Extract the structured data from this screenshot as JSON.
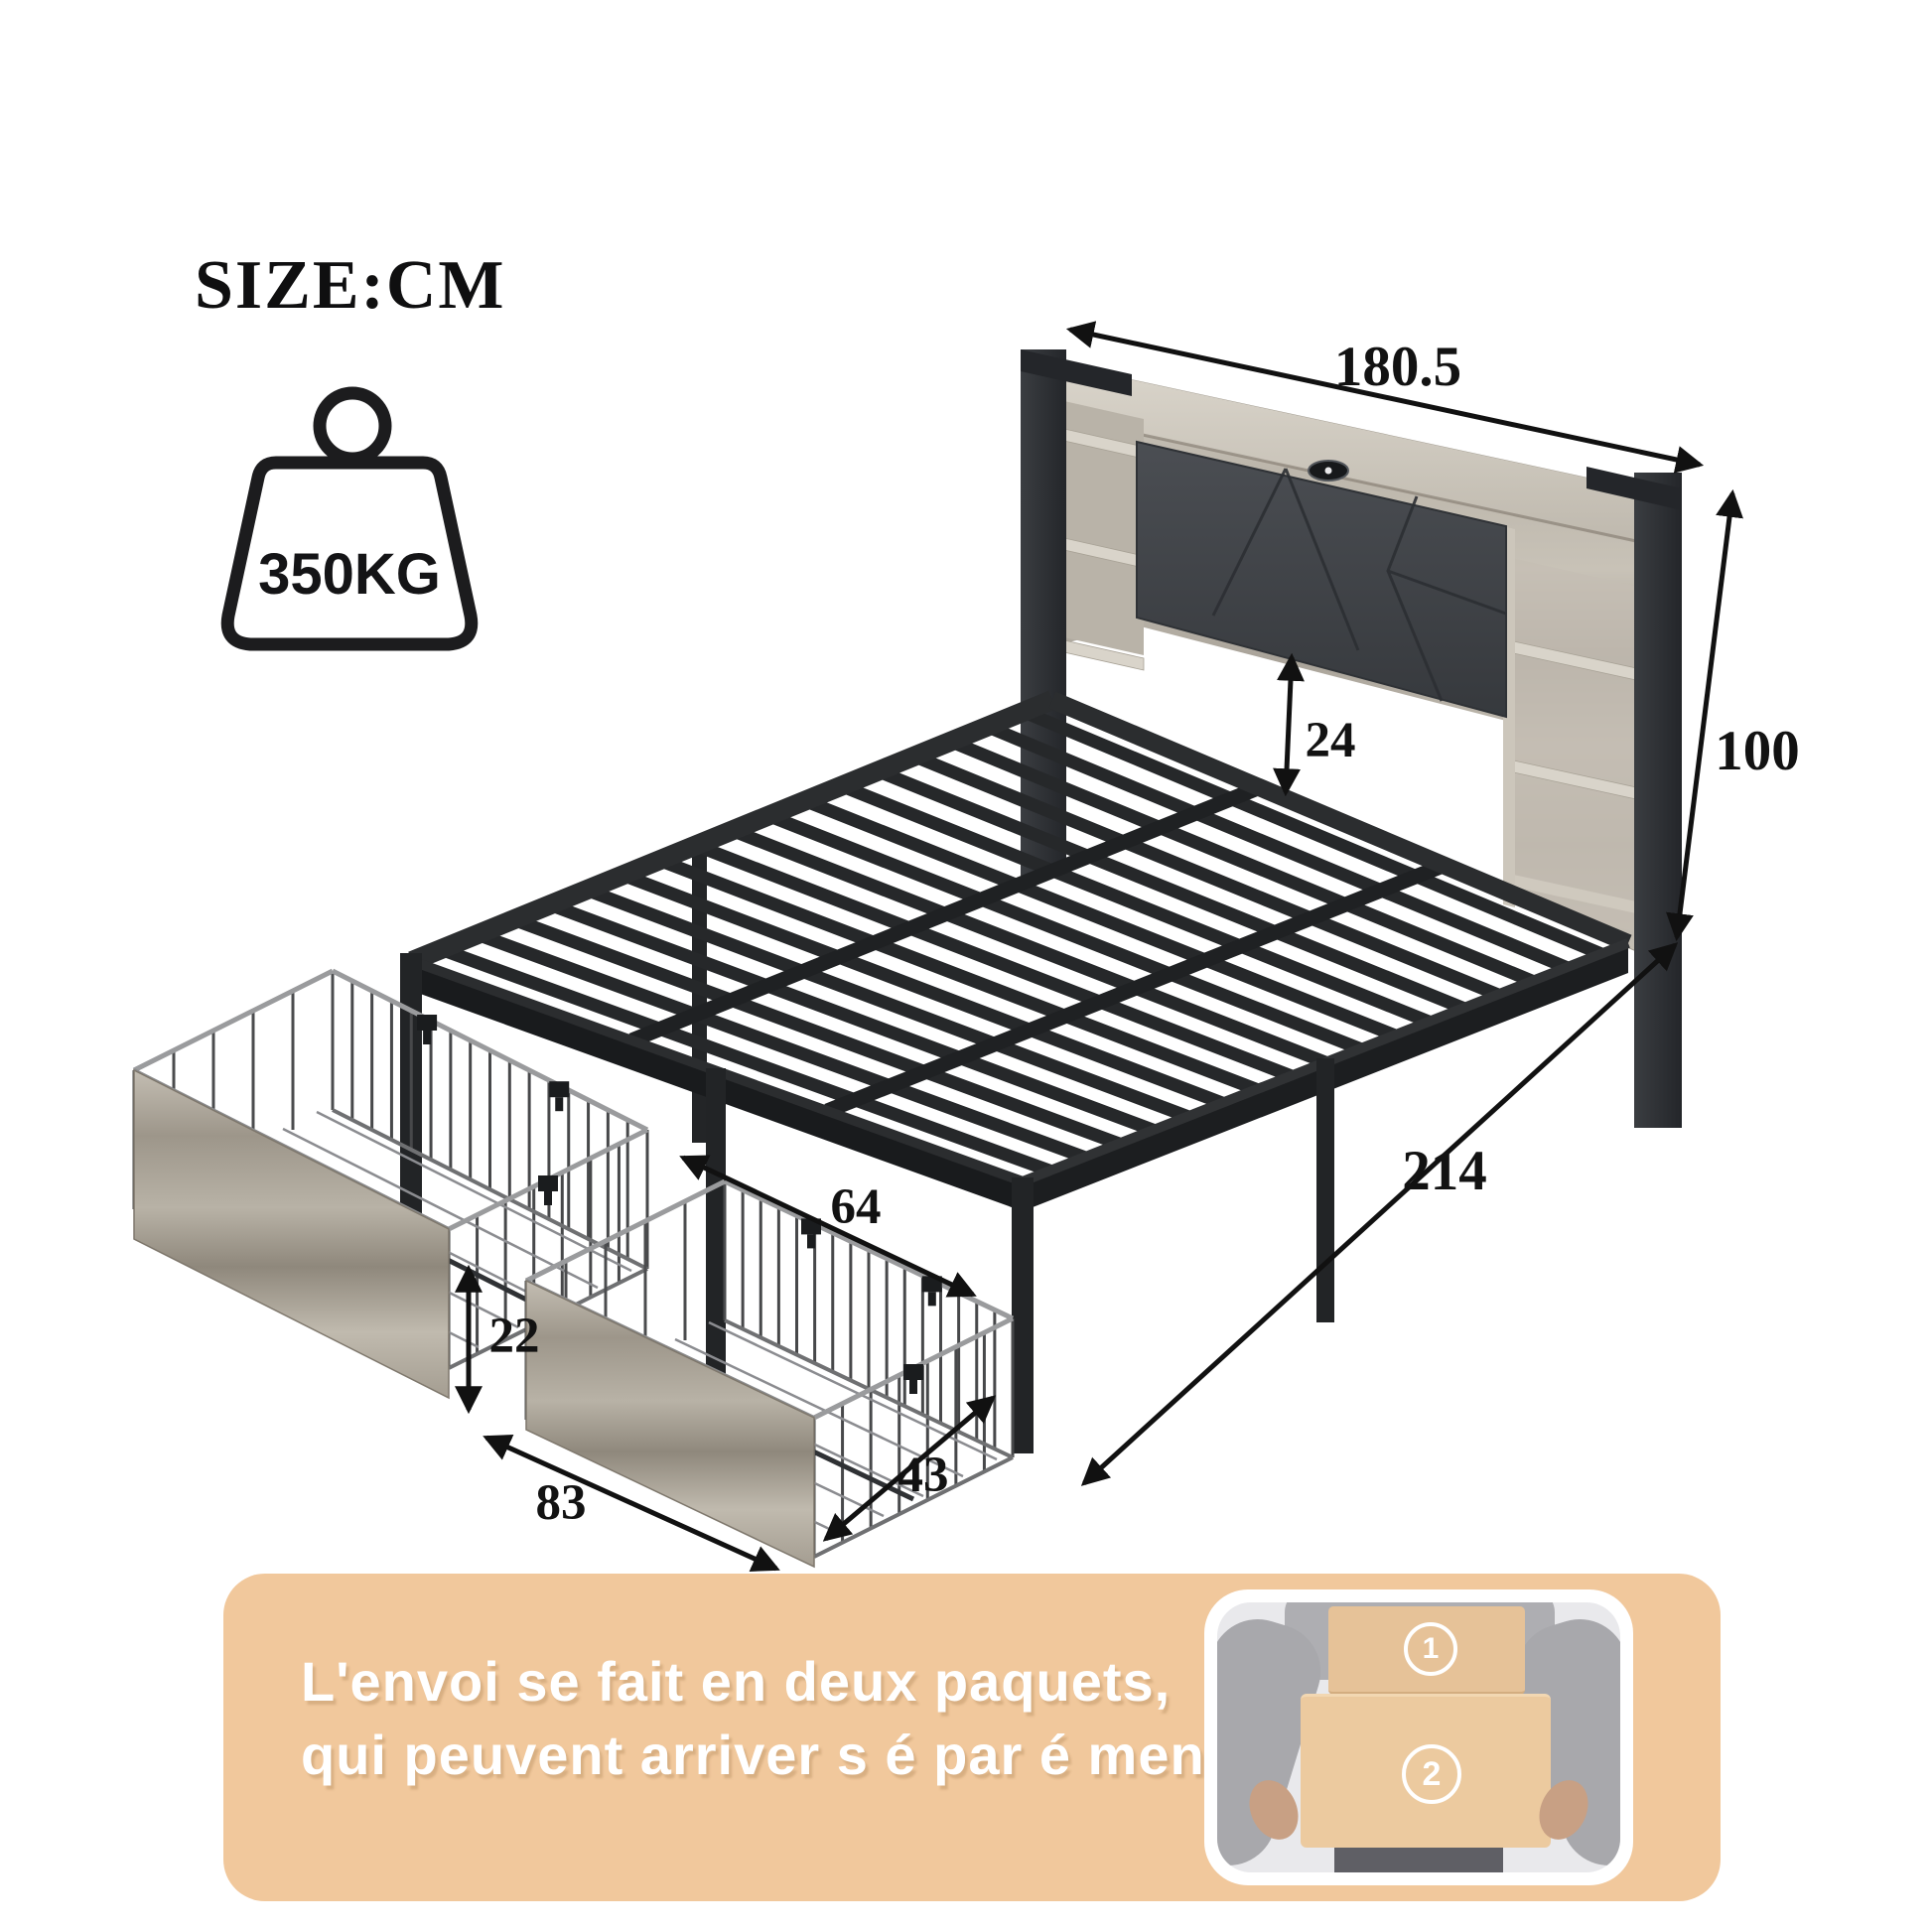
{
  "title": "SIZE:CM",
  "weight": {
    "value": "350KG"
  },
  "icons": {
    "weight_icon": "kettlebell-weight"
  },
  "dims": {
    "width": "180.5",
    "height": "100",
    "headboard_gap": "24",
    "length": "214",
    "drawer_top_length": "64",
    "drawer_height": "22",
    "drawer_front_length": "83",
    "drawer_depth": "43"
  },
  "banner": {
    "line1": "L'envoi se fait en deux paquets,",
    "line2": "qui peuvent arriver s é par é ment.",
    "background": "#f1c89c",
    "text_color": "#ffffff"
  },
  "shipping_photo": {
    "box1": "1",
    "box2": "2"
  },
  "colors": {
    "metal": "#26282a",
    "wood": "#c6c0b5",
    "upholstery": "#44474c",
    "dimension_lines": "#111111"
  }
}
